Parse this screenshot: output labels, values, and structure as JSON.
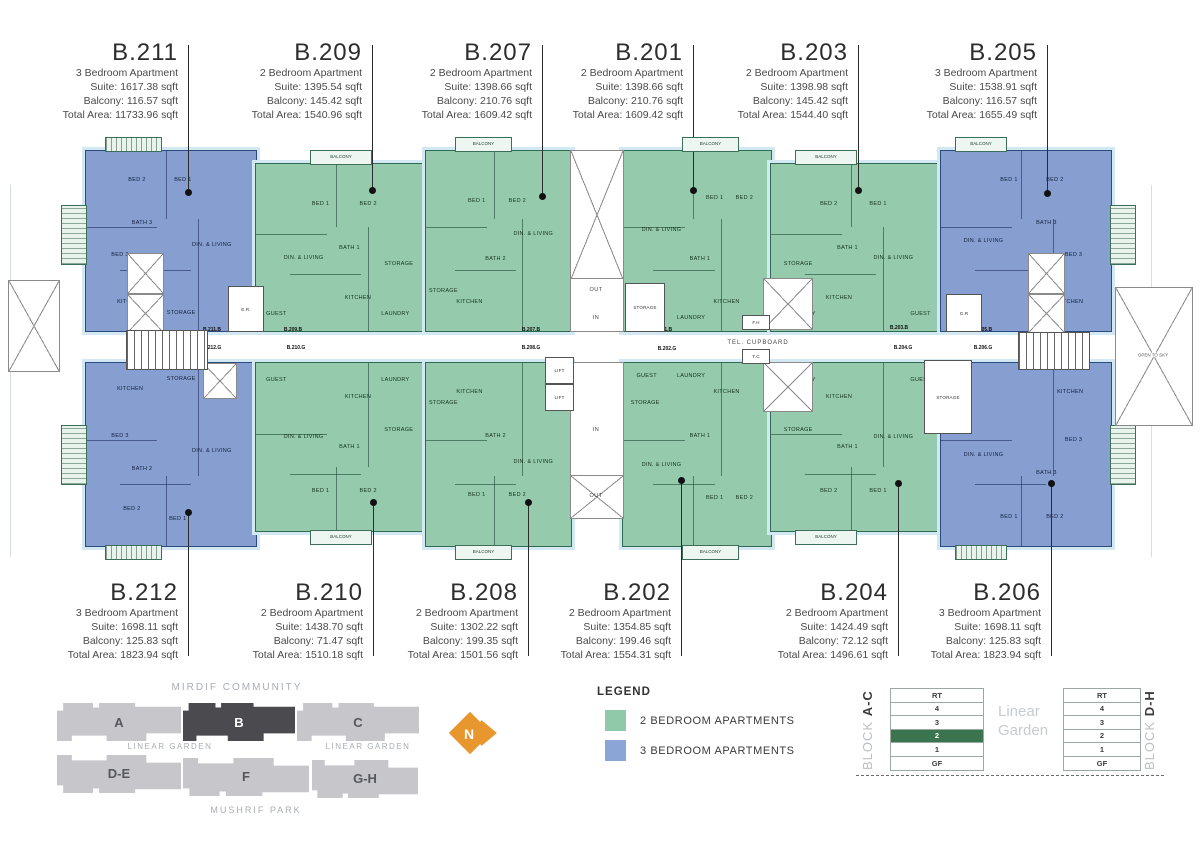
{
  "legend": {
    "title": "LEGEND",
    "items": [
      {
        "label": "2 BEDROOM APARTMENTS",
        "color": "#8fc9a9"
      },
      {
        "label": "3 BEDROOM APARTMENTS",
        "color": "#8ba5d6"
      }
    ]
  },
  "north_arrow": {
    "label": "N",
    "color": "#e8962e"
  },
  "site_map": {
    "top_label": "MIRDIF COMMUNITY",
    "bottom_label": "MUSHRIF PARK",
    "garden_left": "LINEAR GARDEN",
    "garden_right": "LINEAR GARDEN",
    "blocks_top": [
      {
        "label": "A",
        "highlighted": false
      },
      {
        "label": "B",
        "highlighted": true
      },
      {
        "label": "C",
        "highlighted": false
      }
    ],
    "blocks_bottom": [
      {
        "label": "D-E"
      },
      {
        "label": "F"
      },
      {
        "label": "G-H"
      }
    ]
  },
  "floor_selector": {
    "between": "Linear Garden",
    "highlight_color": "#3a7550",
    "left": {
      "block": "BLOCK",
      "range": "A-C",
      "floors": [
        "RT",
        "4",
        "3",
        "2",
        "1",
        "GF"
      ],
      "highlighted": "2"
    },
    "right": {
      "block": "BLOCK",
      "range": "D-H",
      "floors": [
        "RT",
        "4",
        "3",
        "2",
        "1",
        "GF"
      ],
      "highlighted": ""
    }
  },
  "plan_labels": {
    "tel_cupboard": "TEL. CUPBOARD",
    "tc": "T.C",
    "fh": "F.H",
    "gr": "G.R",
    "er": "E.R.",
    "lift": "LIFT",
    "out": "OUT",
    "in": "IN",
    "open_to_sky": "OPEN TO SKY",
    "storage": "STORAGE",
    "balcony": "BALCONY"
  },
  "units": [
    {
      "id": "B.211",
      "row": "top",
      "color": "blue",
      "type_line": "3 Bedroom Apartment",
      "suite_line": "Suite: 1617.38 sqft",
      "balcony_line": "Balcony: 116.57 sqft",
      "total_line": "Total Area: 11733.96 sqft",
      "door_label": "B.211.B",
      "rooms": [
        {
          "label": "BED 2",
          "x": 30,
          "y": 16
        },
        {
          "label": "BED 1",
          "x": 57,
          "y": 16
        },
        {
          "label": "BATH 3",
          "x": 33,
          "y": 40
        },
        {
          "label": "BED 3",
          "x": 20,
          "y": 58
        },
        {
          "label": "DIN. & LIVING",
          "x": 74,
          "y": 52
        },
        {
          "label": "KITCHEN",
          "x": 26,
          "y": 84
        },
        {
          "label": "STORAGE",
          "x": 56,
          "y": 90
        }
      ]
    },
    {
      "id": "B.209",
      "row": "top",
      "color": "green",
      "type_line": "2 Bedroom Apartment",
      "suite_line": "Suite: 1395.54 sqft",
      "balcony_line": "Balcony: 145.42 sqft",
      "total_line": "Total Area: 1540.96 sqft",
      "door_label": "B.209.B",
      "rooms": [
        {
          "label": "BED 1",
          "x": 38,
          "y": 24
        },
        {
          "label": "BED 2",
          "x": 66,
          "y": 24
        },
        {
          "label": "BATH 1",
          "x": 55,
          "y": 50
        },
        {
          "label": "DIN. & LIVING",
          "x": 28,
          "y": 56
        },
        {
          "label": "STORAGE",
          "x": 84,
          "y": 60
        },
        {
          "label": "KITCHEN",
          "x": 60,
          "y": 80
        },
        {
          "label": "GUEST",
          "x": 12,
          "y": 90
        },
        {
          "label": "LAUNDRY",
          "x": 82,
          "y": 90
        }
      ]
    },
    {
      "id": "B.207",
      "row": "top",
      "color": "green",
      "type_line": "2 Bedroom Apartment",
      "suite_line": "Suite: 1398.66 sqft",
      "balcony_line": "Balcony: 210.76 sqft",
      "total_line": "Total Area: 1609.42 sqft",
      "door_label": "B.207.B",
      "rooms": [
        {
          "label": "BED 1",
          "x": 35,
          "y": 28
        },
        {
          "label": "BED 2",
          "x": 63,
          "y": 28
        },
        {
          "label": "DIN. & LIVING",
          "x": 74,
          "y": 46
        },
        {
          "label": "BATH 2",
          "x": 48,
          "y": 60
        },
        {
          "label": "STORAGE",
          "x": 12,
          "y": 78
        },
        {
          "label": "KITCHEN",
          "x": 30,
          "y": 84
        }
      ]
    },
    {
      "id": "B.201",
      "row": "top",
      "color": "green",
      "type_line": "2 Bedroom Apartment",
      "suite_line": "Suite: 1398.66 sqft",
      "balcony_line": "Balcony: 210.76 sqft",
      "total_line": "Total Area: 1609.42 sqft",
      "door_label": "B.201.B",
      "rooms": [
        {
          "label": "BED 1",
          "x": 62,
          "y": 26
        },
        {
          "label": "BED 2",
          "x": 82,
          "y": 26
        },
        {
          "label": "DIN. & LIVING",
          "x": 26,
          "y": 44
        },
        {
          "label": "BATH 1",
          "x": 52,
          "y": 60
        },
        {
          "label": "STORAGE",
          "x": 15,
          "y": 78
        },
        {
          "label": "KITCHEN",
          "x": 70,
          "y": 84
        },
        {
          "label": "GUEST",
          "x": 16,
          "y": 93
        },
        {
          "label": "LAUNDRY",
          "x": 46,
          "y": 93
        }
      ]
    },
    {
      "id": "B.203",
      "row": "top",
      "color": "green",
      "type_line": "2 Bedroom Apartment",
      "suite_line": "Suite: 1398.98 sqft",
      "balcony_line": "Balcony: 145.42 sqft",
      "total_line": "Total Area: 1544.40 sqft",
      "door_label": "B.203.B",
      "rooms": [
        {
          "label": "BED 2",
          "x": 34,
          "y": 24
        },
        {
          "label": "BED 1",
          "x": 63,
          "y": 24
        },
        {
          "label": "BATH 1",
          "x": 45,
          "y": 50
        },
        {
          "label": "DIN. & LIVING",
          "x": 72,
          "y": 56
        },
        {
          "label": "STORAGE",
          "x": 16,
          "y": 60
        },
        {
          "label": "KITCHEN",
          "x": 40,
          "y": 80
        },
        {
          "label": "GUEST",
          "x": 88,
          "y": 90
        },
        {
          "label": "LAUNDRY",
          "x": 18,
          "y": 90
        }
      ]
    },
    {
      "id": "B.205",
      "row": "top",
      "color": "blue",
      "type_line": "3 Bedroom Apartment",
      "suite_line": "Suite: 1538.91 sqft",
      "balcony_line": "Balcony: 116.57 sqft",
      "total_line": "Total Area: 1655.49 sqft",
      "door_label": "B.205.B",
      "rooms": [
        {
          "label": "BED 1",
          "x": 40,
          "y": 16
        },
        {
          "label": "BED 2",
          "x": 67,
          "y": 16
        },
        {
          "label": "BATH 3",
          "x": 62,
          "y": 40
        },
        {
          "label": "BED 3",
          "x": 78,
          "y": 58
        },
        {
          "label": "DIN. & LIVING",
          "x": 25,
          "y": 50
        },
        {
          "label": "KITCHEN",
          "x": 76,
          "y": 84
        }
      ]
    },
    {
      "id": "B.212",
      "row": "bottom",
      "color": "blue",
      "type_line": "3 Bedroom Apartment",
      "suite_line": "Suite: 1698.11 sqft",
      "balcony_line": "Balcony: 125.83 sqft",
      "total_line": "Total Area: 1823.94 sqft",
      "door_label": "B.212.G",
      "rooms": [
        {
          "label": "KITCHEN",
          "x": 26,
          "y": 14
        },
        {
          "label": "STORAGE",
          "x": 56,
          "y": 9
        },
        {
          "label": "BED 3",
          "x": 20,
          "y": 40
        },
        {
          "label": "BATH 2",
          "x": 33,
          "y": 58
        },
        {
          "label": "BED 2",
          "x": 27,
          "y": 80
        },
        {
          "label": "BED 1",
          "x": 54,
          "y": 85
        },
        {
          "label": "DIN. & LIVING",
          "x": 74,
          "y": 48
        }
      ]
    },
    {
      "id": "B.210",
      "row": "bottom",
      "color": "green",
      "type_line": "2 Bedroom Apartment",
      "suite_line": "Suite: 1438.70 sqft",
      "balcony_line": "Balcony: 71.47 sqft",
      "total_line": "Total Area: 1510.18 sqft",
      "door_label": "B.210.G",
      "rooms": [
        {
          "label": "GUEST",
          "x": 12,
          "y": 10
        },
        {
          "label": "LAUNDRY",
          "x": 82,
          "y": 10
        },
        {
          "label": "KITCHEN",
          "x": 60,
          "y": 20
        },
        {
          "label": "STORAGE",
          "x": 84,
          "y": 40
        },
        {
          "label": "BATH 1",
          "x": 55,
          "y": 50
        },
        {
          "label": "DIN. & LIVING",
          "x": 28,
          "y": 44
        },
        {
          "label": "BED 1",
          "x": 38,
          "y": 76
        },
        {
          "label": "BED 2",
          "x": 66,
          "y": 76
        }
      ]
    },
    {
      "id": "B.208",
      "row": "bottom",
      "color": "green",
      "type_line": "2 Bedroom Apartment",
      "suite_line": "Suite: 1302.22 sqft",
      "balcony_line": "Balcony: 199.35 sqft",
      "total_line": "Total Area: 1501.56 sqft",
      "door_label": "B.208.G",
      "rooms": [
        {
          "label": "STORAGE",
          "x": 12,
          "y": 22
        },
        {
          "label": "KITCHEN",
          "x": 30,
          "y": 16
        },
        {
          "label": "BATH 2",
          "x": 48,
          "y": 40
        },
        {
          "label": "DIN. & LIVING",
          "x": 74,
          "y": 54
        },
        {
          "label": "BED 1",
          "x": 35,
          "y": 72
        },
        {
          "label": "BED 2",
          "x": 63,
          "y": 72
        }
      ]
    },
    {
      "id": "B.202",
      "row": "bottom",
      "color": "green",
      "type_line": "2 Bedroom Apartment",
      "suite_line": "Suite: 1354.85 sqft",
      "balcony_line": "Balcony: 199.46 sqft",
      "total_line": "Total Area: 1554.31 sqft",
      "door_label": "B.202.G",
      "rooms": [
        {
          "label": "GUEST",
          "x": 16,
          "y": 7
        },
        {
          "label": "LAUNDRY",
          "x": 46,
          "y": 7
        },
        {
          "label": "STORAGE",
          "x": 15,
          "y": 22
        },
        {
          "label": "KITCHEN",
          "x": 70,
          "y": 16
        },
        {
          "label": "BATH 1",
          "x": 52,
          "y": 40
        },
        {
          "label": "DIN. & LIVING",
          "x": 26,
          "y": 56
        },
        {
          "label": "BED 1",
          "x": 62,
          "y": 74
        },
        {
          "label": "BED 2",
          "x": 82,
          "y": 74
        }
      ]
    },
    {
      "id": "B.204",
      "row": "bottom",
      "color": "green",
      "type_line": "2 Bedroom Apartment",
      "suite_line": "Suite: 1424.49 sqft",
      "balcony_line": "Balcony: 72.12 sqft",
      "total_line": "Total Area: 1496.61 sqft",
      "door_label": "B.204.G",
      "rooms": [
        {
          "label": "GUEST",
          "x": 88,
          "y": 10
        },
        {
          "label": "LAUNDRY",
          "x": 18,
          "y": 10
        },
        {
          "label": "STORAGE",
          "x": 16,
          "y": 40
        },
        {
          "label": "KITCHEN",
          "x": 40,
          "y": 20
        },
        {
          "label": "BATH 1",
          "x": 45,
          "y": 50
        },
        {
          "label": "DIN. & LIVING",
          "x": 72,
          "y": 44
        },
        {
          "label": "BED 2",
          "x": 34,
          "y": 76
        },
        {
          "label": "BED 1",
          "x": 63,
          "y": 76
        }
      ]
    },
    {
      "id": "B.206",
      "row": "bottom",
      "color": "blue",
      "type_line": "3 Bedroom Apartment",
      "suite_line": "Suite: 1698.11 sqft",
      "balcony_line": "Balcony: 125.83 sqft",
      "total_line": "Total Area: 1823.94 sqft",
      "door_label": "B.206.G",
      "rooms": [
        {
          "label": "KITCHEN",
          "x": 76,
          "y": 16
        },
        {
          "label": "DIN. & LIVING",
          "x": 25,
          "y": 50
        },
        {
          "label": "BED 3",
          "x": 78,
          "y": 42
        },
        {
          "label": "BATH 3",
          "x": 62,
          "y": 60
        },
        {
          "label": "BED 2",
          "x": 67,
          "y": 84
        },
        {
          "label": "BED 1",
          "x": 40,
          "y": 84
        }
      ]
    }
  ]
}
